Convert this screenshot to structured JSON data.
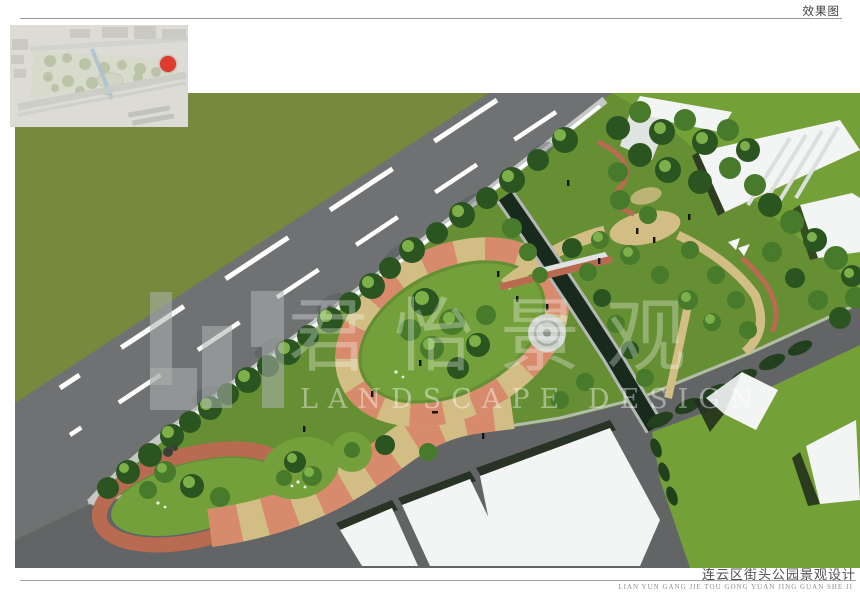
{
  "header": {
    "label": "效果图"
  },
  "watermark": {
    "logo_icon": "junyi-landscape-logo-blocks",
    "cjk": "君怡景观",
    "en": "LANDSCAPE DESIGN"
  },
  "inset_map": {
    "marker_icon": "red-location-dot"
  },
  "footer": {
    "title": "连云区街头公园景观设计",
    "pinyin": "LIAN YUN GANG JIE TOU GONG YUAN JING GUAN SHE JI"
  },
  "colors": {
    "field_olive": "#77893c",
    "grass_vivid": "#74a038",
    "road_main": "#6f7173",
    "road_dark": "#626466",
    "lawn": "#668e33",
    "lawn_light": "#74a03c",
    "tree_dark": "#2a5520",
    "tree_mid": "#477a2a",
    "tree_light": "#7eb04a",
    "canal_water": "#182a1c",
    "canal_wall": "#b4b8b4",
    "path_tan": "#d2be85",
    "path_salmon": "#d78b6c",
    "path_brick": "#b96b52",
    "curb": "#c6c8c5",
    "building_white": "#f3f5f4",
    "building_shade": "#dfe3e1",
    "shadow_dark": "#1e2a1a",
    "hedge": "#23401e",
    "marker_red": "#e0392e"
  }
}
